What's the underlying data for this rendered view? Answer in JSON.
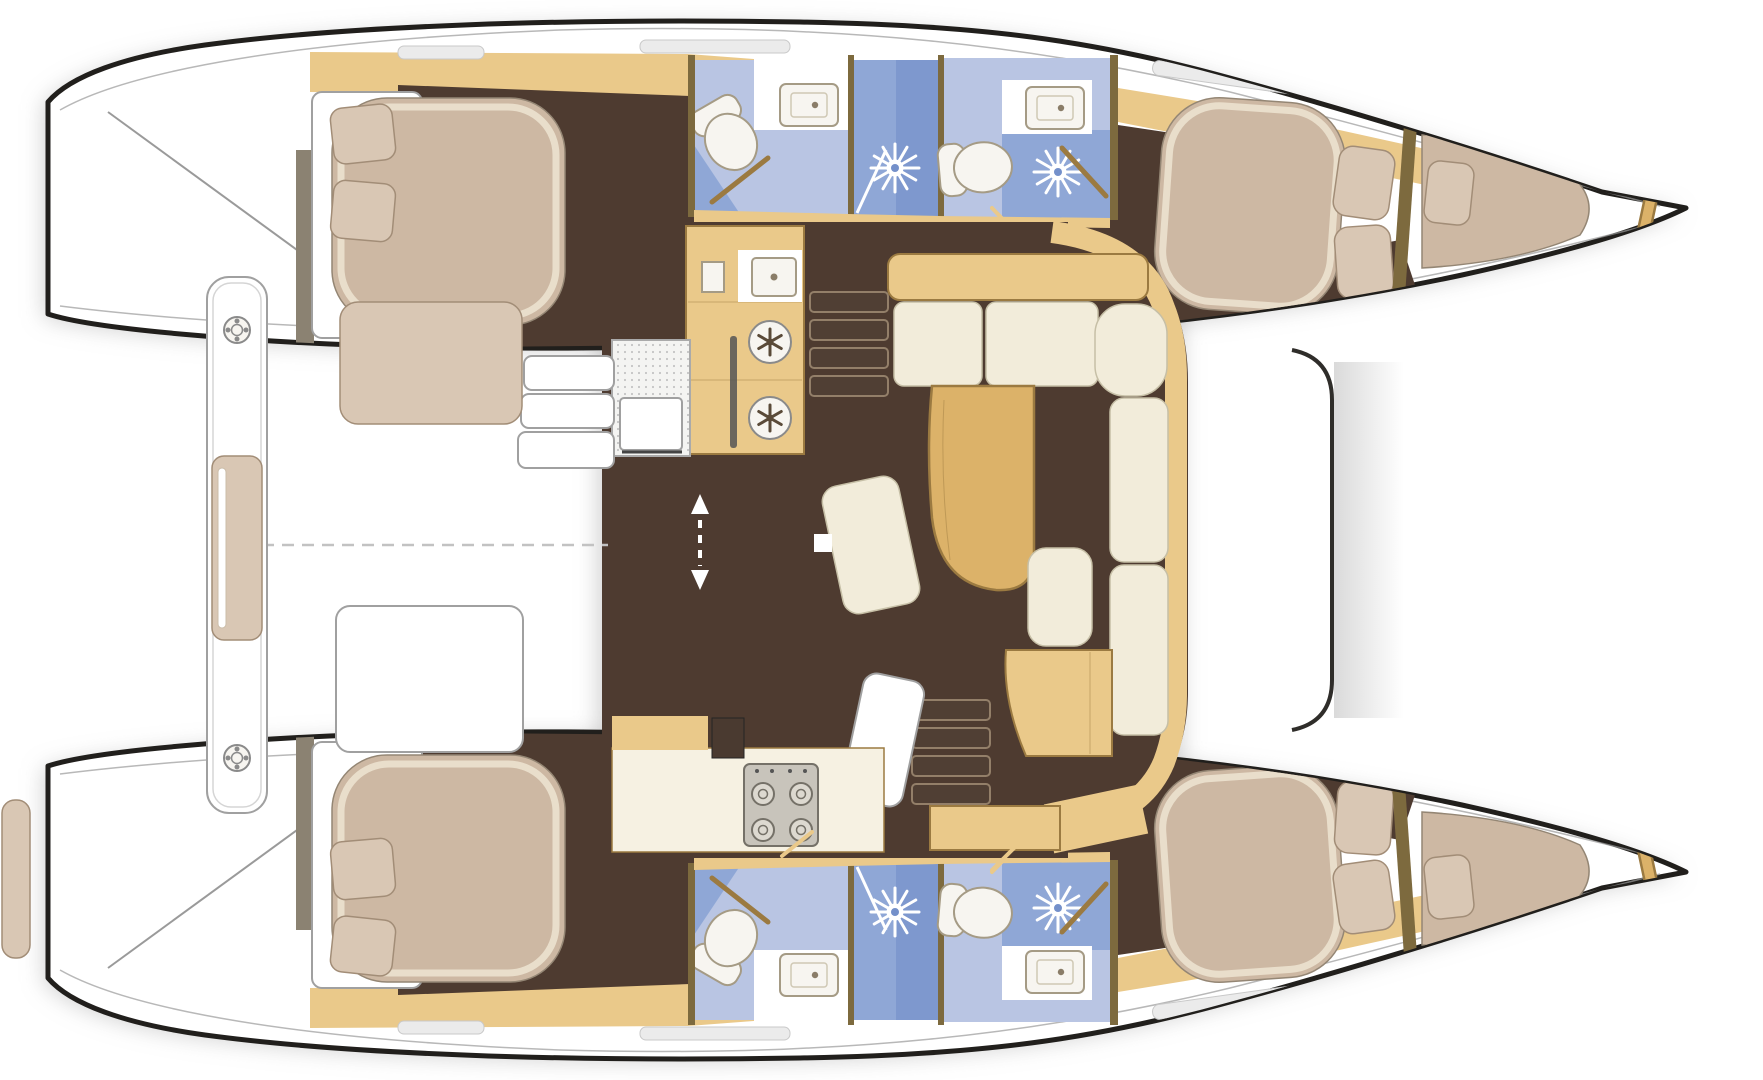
{
  "meta": {
    "type": "boat-floorplan",
    "view": "top-down",
    "vessel": "sailing-catamaran",
    "canvas": {
      "width": 1763,
      "height": 1080
    }
  },
  "colors": {
    "bg": "#ffffff",
    "shadow": "#a0a0a0",
    "hullFill": "#ffffff",
    "hullStroke": "#211f1c",
    "deckLine": "#9a9a9a",
    "floorDark": "#4e3b30",
    "woodLight": "#eac98a",
    "woodMid": "#dcb269",
    "woodDark": "#9b7a41",
    "woodWall": "#7d6a3e",
    "bulkhead": "#8b8272",
    "counterCream": "#f6f1e2",
    "cushionCream": "#f2ecda",
    "cushionStroke": "#c6bfa6",
    "mattress": "#cdb8a3",
    "mattressHi": "#ece2cf",
    "mattressStroke": "#948674",
    "pillow": "#d9c7b4",
    "pillowStroke": "#a28d77",
    "bathLight": "#b9c5e3",
    "bathMid": "#8fa7d6",
    "bathDeep": "#7490ca",
    "fixtureWhite": "#f7f5f0",
    "fixtureStroke": "#a59b85",
    "stoveGrey": "#c8c4bb",
    "stoveEdge": "#757168",
    "gridDot": "#c4c4c4",
    "dash": "#c2c2c2",
    "beam": "#2f2d2a",
    "hatchGrey": "#8a8a8a"
  },
  "layout": {
    "orientation": "bows-to-right",
    "hull_count": 2,
    "cabins": [
      {
        "id": "port-aft-cabin",
        "berths": 1,
        "pillows": 2
      },
      {
        "id": "port-forward-cabin",
        "berths": 1,
        "pillows": 2,
        "forepeak_berth": true,
        "forepeak_pillows": 1
      },
      {
        "id": "starboard-aft-cabin",
        "berths": 1,
        "pillows": 2
      },
      {
        "id": "starboard-forward-cabin",
        "berths": 1,
        "pillows": 2,
        "forepeak_berth": true,
        "forepeak_pillows": 1
      }
    ],
    "heads": [
      {
        "id": "port-heads",
        "toilets": 2,
        "sinks": 2,
        "shower_heads": 2
      },
      {
        "id": "starboard-heads",
        "toilets": 2,
        "sinks": 2,
        "shower_heads": 2
      }
    ],
    "salon": {
      "galley_sink": 1,
      "fridge_lids": 2,
      "stove_burners": 4,
      "oven": 1,
      "icebox_grate": 1,
      "settee_cushions": 6,
      "table": "curved-wood",
      "chaise": 1,
      "nav_desk": 1,
      "nav_seat": 1,
      "companionway_step_sets": 2,
      "entry_steps": 3,
      "sliding_door_arrow": 1
    },
    "cockpit": {
      "bench_cushions": 2,
      "table": 1,
      "deck_plates": 2,
      "centerline": "dashed",
      "transom_steps": "both-hulls"
    },
    "foredeck": {
      "forward_beam": 1,
      "trampoline": "open-white"
    }
  }
}
